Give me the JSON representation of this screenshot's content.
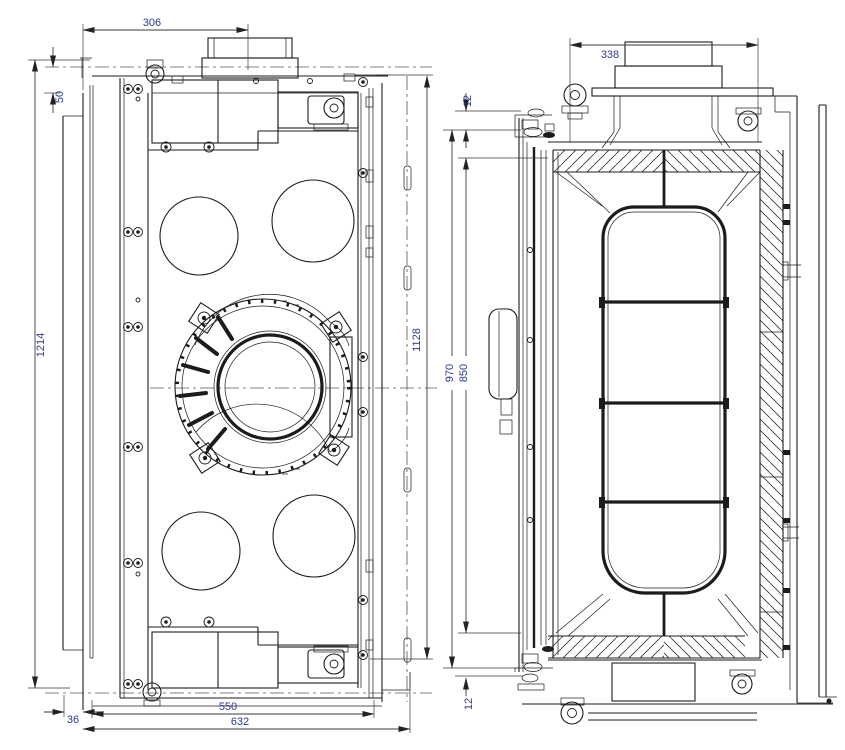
{
  "colors": {
    "background": "#ffffff",
    "line": "#1c1c1c",
    "dim_line": "#3a3a3a",
    "dim_text": "#2b3990"
  },
  "front_view": {
    "dim_flue_center": "306",
    "dim_top_recess": "50",
    "dim_overall_height": "1214",
    "dim_body_height": "1128",
    "dim_flange_width": "36",
    "dim_body_width": "550",
    "dim_overall_width": "632"
  },
  "side_view": {
    "dim_flue_center": "338",
    "dim_top_gap": "12",
    "dim_glass_height": "850",
    "dim_frame_height": "970",
    "dim_bottom_gap": "12"
  }
}
